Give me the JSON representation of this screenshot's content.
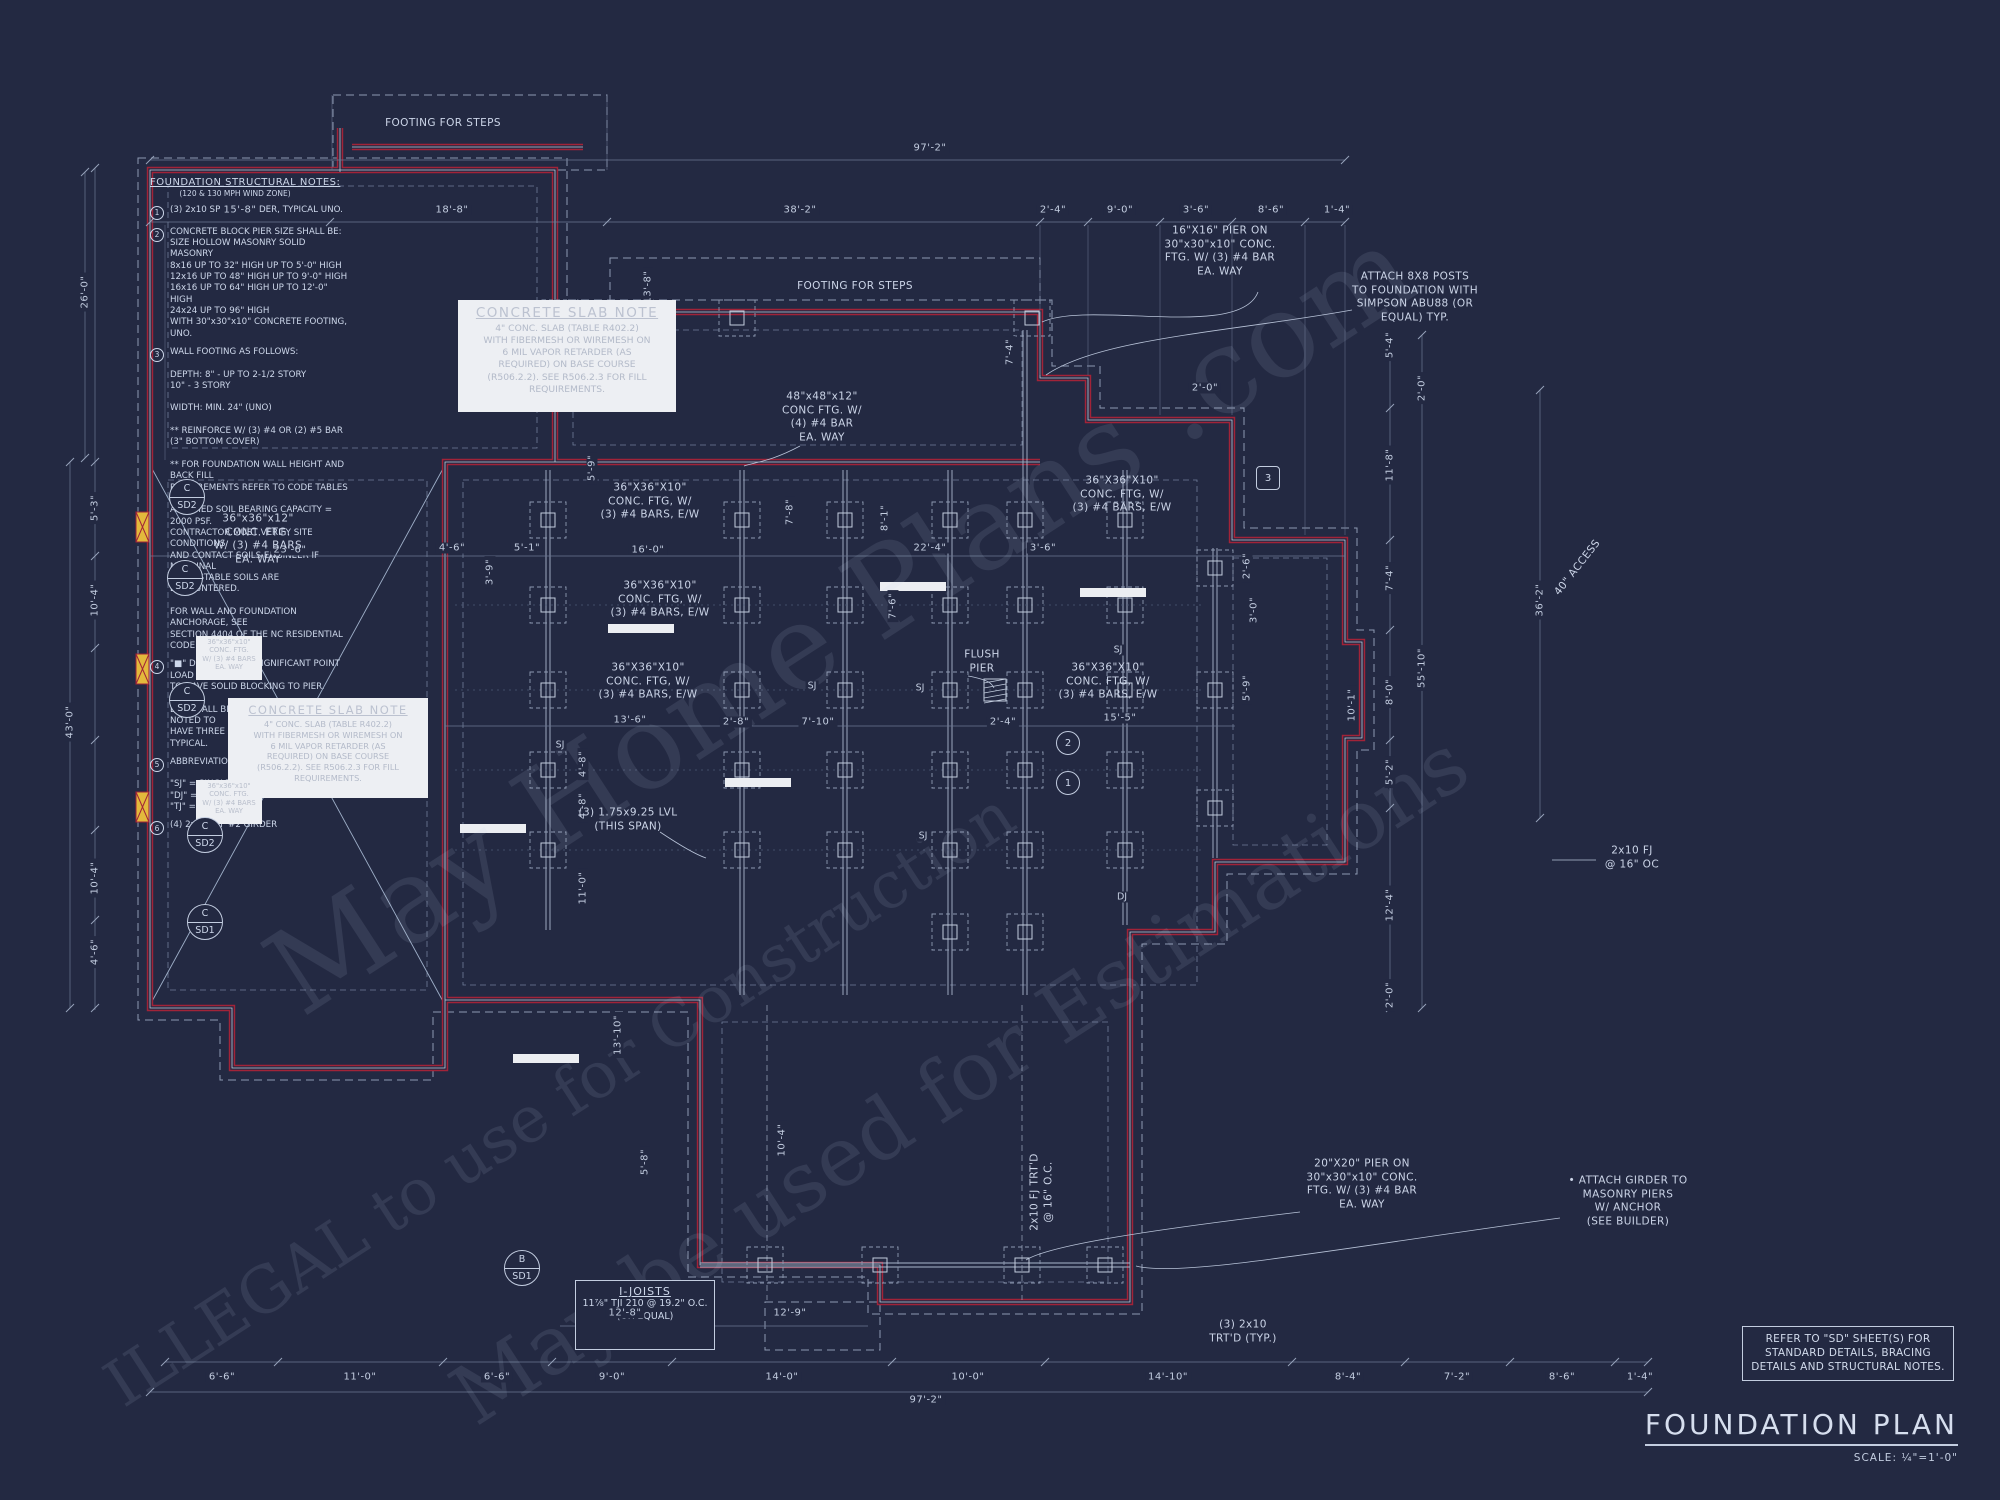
{
  "sheet": {
    "background": "#232942",
    "line_color": "#b9c4d9",
    "red_color": "#a22338",
    "yellow_color": "#e3b93c",
    "title": "FOUNDATION PLAN",
    "scale_label": "SCALE: ¼\"=1'-0\"",
    "refer_note": "REFER TO \"SD\" SHEET(S) FOR STANDARD DETAILS, BRACING DETAILS AND STRUCTURAL NOTES."
  },
  "structural_notes": {
    "title": "FOUNDATION STRUCTURAL NOTES:",
    "subtitle": "(120 & 130 MPH WIND ZONE)",
    "items": [
      {
        "num": "1",
        "text": "(3) 2x10 SPF #2 GIRDER, TYPICAL UNO."
      },
      {
        "num": "2",
        "text": "CONCRETE BLOCK PIER SIZE SHALL BE:\nSIZE   HOLLOW MASONRY   SOLID MASONRY\n8x16    UP TO 32\" HIGH    UP TO 5'-0\" HIGH\n12x16   UP TO 48\" HIGH    UP TO 9'-0\" HIGH\n16x16   UP TO 64\" HIGH    UP TO 12'-0\" HIGH\n24x24   UP TO 96\" HIGH\nWITH 30\"x30\"x10\" CONCRETE FOOTING, UNO."
      },
      {
        "num": "3",
        "text": "WALL FOOTING AS FOLLOWS:\n\nDEPTH: 8\" - UP TO 2-1/2 STORY\n      10\" - 3 STORY\n\nWIDTH: MIN. 24\" (UNO)\n\n** REINFORCE W/ (3) #4 OR (2) #5 BAR\n(3\" BOTTOM COVER)\n\n** FOR FOUNDATION WALL HEIGHT AND BACK FILL\nREQUIREMENTS REFER TO CODE TABLES R404.1.\nASSUMED SOIL BEARING CAPACITY = 2000 PSF.\nCONTRACTOR MUST VERIFY SITE CONDITIONS\nAND CONTACT SOILS ENGINEER IF MARGINAL\nOR UNSTABLE SOILS ARE ENCOUNTERED.\n\nFOR WALL AND FOUNDATION ANCHORAGE, SEE\nSECTION 4404 OF THE NC RESIDENTIAL CODE."
      },
      {
        "num": "4",
        "text": "\"■\" DESIGNATES A SIGNIFICANT POINT LOAD\nTO HAVE SOLID BLOCKING TO PIER. SOLID\nBLOCK ALL BEAM BEARING POINTS NOTED TO\nHAVE THREE OR MORE STUDS TO FND. TYPICAL."
      },
      {
        "num": "5",
        "text": "ABBREVIATIONS:\n\n\"SJ\" = SINGLE JOIST\n\"DJ\" = DOUBLE JOIST\n\"TJ\" = TRIPLE JOIST"
      },
      {
        "num": "6",
        "text": "(4) 2x10 SPF #2 GIRDER"
      }
    ]
  },
  "concrete_slab_note": {
    "title": "CONCRETE SLAB NOTE",
    "body": "4\" CONC. SLAB (TABLE R402.2)\nWITH FIBERMESH OR WIREMESH ON\n6 MIL VAPOR RETARDER (AS\nREQUIRED) ON BASE COURSE\n(R506.2.2). SEE R506.2.3 FOR FILL\nREQUIREMENTS.",
    "instances": [
      {
        "x": 458,
        "y": 300,
        "w": 218,
        "h": 112,
        "small": false
      },
      {
        "x": 228,
        "y": 698,
        "w": 200,
        "h": 100,
        "small": true
      }
    ]
  },
  "i_joists_note": {
    "title": "I-JOISTS",
    "lines": [
      "11⅞\" TJI 210",
      "@ 19.2\" O.C.",
      "(OR EQUAL)"
    ],
    "x": 575,
    "y": 1280,
    "w": 140,
    "h": 70
  },
  "small_footing_boxes": {
    "text": "36\"x36\"x10\"\nCONC. FTG.\nW/ (3) #4 BARS\nEA. WAY",
    "instances": [
      {
        "x": 196,
        "y": 636,
        "w": 66,
        "h": 44
      },
      {
        "x": 196,
        "y": 780,
        "w": 66,
        "h": 44
      }
    ]
  },
  "dimensions": [
    {
      "t": "97'-2\"",
      "x": 930,
      "y": 148
    },
    {
      "t": "15'-8\"",
      "x": 240,
      "y": 210
    },
    {
      "t": "18'-8\"",
      "x": 452,
      "y": 210
    },
    {
      "t": "38'-2\"",
      "x": 800,
      "y": 210
    },
    {
      "t": "2'-4\"",
      "x": 1053,
      "y": 210
    },
    {
      "t": "9'-0\"",
      "x": 1120,
      "y": 210
    },
    {
      "t": "3'-6\"",
      "x": 1196,
      "y": 210
    },
    {
      "t": "8'-6\"",
      "x": 1271,
      "y": 210
    },
    {
      "t": "1'-4\"",
      "x": 1337,
      "y": 210
    },
    {
      "t": "13'-8\"",
      "x": 648,
      "y": 287,
      "r": -90
    },
    {
      "t": "7'-4\"",
      "x": 1010,
      "y": 352,
      "r": -90
    },
    {
      "t": "2'-0\"",
      "x": 1205,
      "y": 388
    },
    {
      "t": "26'-0\"",
      "x": 85,
      "y": 292,
      "r": -90
    },
    {
      "t": "5'-3\"",
      "x": 95,
      "y": 508,
      "r": -90
    },
    {
      "t": "10'-4\"",
      "x": 95,
      "y": 600,
      "r": -90
    },
    {
      "t": "43'-0\"",
      "x": 70,
      "y": 722,
      "r": -90
    },
    {
      "t": "10'-4\"",
      "x": 95,
      "y": 878,
      "r": -90
    },
    {
      "t": "4'-6\"",
      "x": 95,
      "y": 952,
      "r": -90
    },
    {
      "t": "5'-4\"",
      "x": 1390,
      "y": 345,
      "r": -90
    },
    {
      "t": "2'-0\"",
      "x": 1422,
      "y": 388,
      "r": -90
    },
    {
      "t": "11'-8\"",
      "x": 1390,
      "y": 465,
      "r": -90
    },
    {
      "t": "7'-4\"",
      "x": 1390,
      "y": 578,
      "r": -90
    },
    {
      "t": "36'-2\"",
      "x": 1540,
      "y": 600,
      "r": -90
    },
    {
      "t": "55'-10\"",
      "x": 1422,
      "y": 668,
      "r": -90
    },
    {
      "t": "8'-0\"",
      "x": 1390,
      "y": 692,
      "r": -90
    },
    {
      "t": "10'-1\"",
      "x": 1352,
      "y": 705,
      "r": -90
    },
    {
      "t": "5'-2\"",
      "x": 1390,
      "y": 772,
      "r": -90
    },
    {
      "t": "12'-4\"",
      "x": 1390,
      "y": 905,
      "r": -90
    },
    {
      "t": "2'-0\"",
      "x": 1390,
      "y": 995,
      "r": -90
    },
    {
      "t": "23'-6\"",
      "x": 290,
      "y": 550
    },
    {
      "t": "4'-6\"",
      "x": 452,
      "y": 548
    },
    {
      "t": "5'-1\"",
      "x": 527,
      "y": 548
    },
    {
      "t": "16'-0\"",
      "x": 648,
      "y": 550
    },
    {
      "t": "22'-4\"",
      "x": 930,
      "y": 548
    },
    {
      "t": "3'-6\"",
      "x": 1043,
      "y": 548
    },
    {
      "t": "3'-9\"",
      "x": 490,
      "y": 572,
      "r": -90
    },
    {
      "t": "2'-6\"",
      "x": 1247,
      "y": 566,
      "r": -90
    },
    {
      "t": "3'-0\"",
      "x": 1254,
      "y": 610,
      "r": -90
    },
    {
      "t": "5'-9\"",
      "x": 592,
      "y": 468,
      "r": -90
    },
    {
      "t": "7'-8\"",
      "x": 790,
      "y": 512,
      "r": -90
    },
    {
      "t": "8'-1\"",
      "x": 885,
      "y": 518,
      "r": -90
    },
    {
      "t": "7'-6\"",
      "x": 893,
      "y": 606,
      "r": -90
    },
    {
      "t": "13'-6\"",
      "x": 630,
      "y": 720
    },
    {
      "t": "2'-8\"",
      "x": 736,
      "y": 722
    },
    {
      "t": "7'-10\"",
      "x": 818,
      "y": 722
    },
    {
      "t": "2'-4\"",
      "x": 1003,
      "y": 722
    },
    {
      "t": "15'-5\"",
      "x": 1120,
      "y": 718
    },
    {
      "t": "5'-9\"",
      "x": 1247,
      "y": 688,
      "r": -90
    },
    {
      "t": "4'-8\"",
      "x": 583,
      "y": 764,
      "r": -90
    },
    {
      "t": "4'-8\"",
      "x": 583,
      "y": 806,
      "r": -90
    },
    {
      "t": "11'-0\"",
      "x": 583,
      "y": 888,
      "r": -90
    },
    {
      "t": "13'-10\"",
      "x": 618,
      "y": 1035,
      "r": -90
    },
    {
      "t": "5'-8\"",
      "x": 645,
      "y": 1162,
      "r": -90
    },
    {
      "t": "10'-4\"",
      "x": 782,
      "y": 1140,
      "r": -90
    },
    {
      "t": "12'-8\"",
      "x": 625,
      "y": 1313
    },
    {
      "t": "12'-9\"",
      "x": 790,
      "y": 1313
    },
    {
      "t": "6'-6\"",
      "x": 222,
      "y": 1377
    },
    {
      "t": "11'-0\"",
      "x": 360,
      "y": 1377
    },
    {
      "t": "6'-6\"",
      "x": 497,
      "y": 1377
    },
    {
      "t": "9'-0\"",
      "x": 612,
      "y": 1377
    },
    {
      "t": "14'-0\"",
      "x": 782,
      "y": 1377
    },
    {
      "t": "10'-0\"",
      "x": 968,
      "y": 1377
    },
    {
      "t": "14'-10\"",
      "x": 1168,
      "y": 1377
    },
    {
      "t": "8'-4\"",
      "x": 1348,
      "y": 1377
    },
    {
      "t": "7'-2\"",
      "x": 1457,
      "y": 1377
    },
    {
      "t": "8'-6\"",
      "x": 1562,
      "y": 1377
    },
    {
      "t": "1'-4\"",
      "x": 1640,
      "y": 1377
    },
    {
      "t": "97'-2\"",
      "x": 926,
      "y": 1400
    }
  ],
  "annotations": [
    {
      "lines": [
        "FOOTING FOR STEPS"
      ],
      "x": 443,
      "y": 124
    },
    {
      "lines": [
        "FOOTING FOR STEPS"
      ],
      "x": 855,
      "y": 287
    },
    {
      "lines": [
        "16\"X16\" PIER ON",
        "30\"x30\"x10\" CONC.",
        "FTG. W/ (3) #4 BAR",
        "EA. WAY"
      ],
      "x": 1220,
      "y": 252
    },
    {
      "lines": [
        "ATTACH 8X8 POSTS",
        "TO FOUNDATION WITH",
        "SIMPSON ABU88 (OR",
        "EQUAL) TYP."
      ],
      "x": 1415,
      "y": 298
    },
    {
      "lines": [
        "48\"x48\"x12\"",
        "CONC FTG. W/",
        "(4) #4 BAR",
        "EA. WAY"
      ],
      "x": 822,
      "y": 418
    },
    {
      "lines": [
        "36\"x36\"x12\"",
        "CONC. FTG.",
        "W/ (3) #4 BARS",
        "EA. WAY"
      ],
      "x": 258,
      "y": 540
    },
    {
      "lines": [
        "36\"X36\"X10\"",
        "CONC. FTG, W/",
        "(3) #4 BARS, E/W"
      ],
      "x": 650,
      "y": 502
    },
    {
      "lines": [
        "36\"X36\"X10\"",
        "CONC. FTG, W/",
        "(3) #4 BARS, E/W"
      ],
      "x": 660,
      "y": 600
    },
    {
      "lines": [
        "36\"X36\"X10\"",
        "CONC. FTG, W/",
        "(3) #4 BARS, E/W"
      ],
      "x": 648,
      "y": 682
    },
    {
      "lines": [
        "36\"X36\"X10\"",
        "CONC. FTG, W/",
        "(3) #4 BARS, E/W"
      ],
      "x": 1122,
      "y": 495
    },
    {
      "lines": [
        "36\"X36\"X10\"",
        "CONC. FTG, W/",
        "(3) #4 BARS, E/W"
      ],
      "x": 1108,
      "y": 682
    },
    {
      "lines": [
        "20\"X20\" PIER ON",
        "30\"x30\"x10\" CONC.",
        "FTG. W/ (3) #4 BAR",
        "EA. WAY"
      ],
      "x": 1362,
      "y": 1185
    },
    {
      "lines": [
        "• ATTACH GIRDER TO",
        "MASONRY PIERS",
        "W/ ANCHOR",
        "(SEE BUILDER)"
      ],
      "x": 1628,
      "y": 1202
    },
    {
      "lines": [
        "(3) 1.75x9.25 LVL",
        "(THIS SPAN)"
      ],
      "x": 628,
      "y": 820
    },
    {
      "lines": [
        "(3) 2x10",
        "TRT'D (TYP.)"
      ],
      "x": 1243,
      "y": 1332
    },
    {
      "lines": [
        "FLUSH",
        "PIER"
      ],
      "x": 982,
      "y": 662
    },
    {
      "lines": [
        "2x10 FJ",
        "@ 16\" OC"
      ],
      "x": 1632,
      "y": 858
    },
    {
      "lines": [
        "40\" ACCESS"
      ],
      "x": 1578,
      "y": 568,
      "r": -52
    },
    {
      "lines": [
        "2x10 FJ TRT'D",
        "@ 16\" O.C."
      ],
      "x": 1042,
      "y": 1192,
      "r": -90
    }
  ],
  "joist_tags": [
    {
      "t": "SJ",
      "x": 560,
      "y": 745
    },
    {
      "t": "SJ",
      "x": 812,
      "y": 686
    },
    {
      "t": "SJ",
      "x": 920,
      "y": 688
    },
    {
      "t": "SJ",
      "x": 1118,
      "y": 650
    },
    {
      "t": "SJ",
      "x": 923,
      "y": 836
    },
    {
      "t": "DJ",
      "x": 1122,
      "y": 897
    }
  ],
  "callouts": [
    {
      "top": "C",
      "bottom": "SD2",
      "x": 187,
      "y": 497
    },
    {
      "top": "C",
      "bottom": "SD2",
      "x": 185,
      "y": 578
    },
    {
      "top": "C",
      "bottom": "SD2",
      "x": 187,
      "y": 700
    },
    {
      "top": "C",
      "bottom": "SD2",
      "x": 205,
      "y": 835
    },
    {
      "top": "C",
      "bottom": "SD1",
      "x": 205,
      "y": 922
    },
    {
      "top": "B",
      "bottom": "SD1",
      "x": 522,
      "y": 1268
    }
  ],
  "ref_markers": [
    {
      "label": "3",
      "shape": "hex",
      "x": 1268,
      "y": 478
    },
    {
      "label": "2",
      "shape": "circle",
      "x": 1068,
      "y": 743
    },
    {
      "label": "1",
      "shape": "circle",
      "x": 1068,
      "y": 783
    }
  ],
  "watermarks": [
    {
      "text": "May Home Plans .com",
      "x": 840,
      "y": 620,
      "size": 118,
      "opacity": 0.1
    },
    {
      "text": "ILLEGAL to use for Construction",
      "x": 560,
      "y": 1100,
      "size": 64,
      "opacity": 0.1
    },
    {
      "text": "May be used for Estimations",
      "x": 960,
      "y": 1080,
      "size": 82,
      "opacity": 0.1
    }
  ]
}
